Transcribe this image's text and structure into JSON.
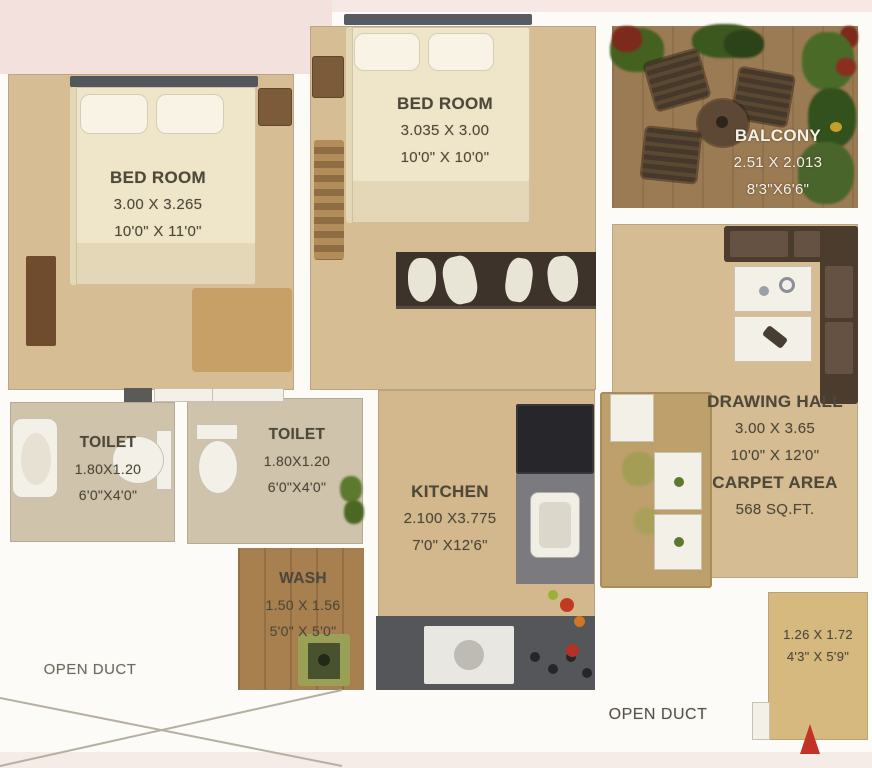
{
  "plan_title": "2 BHK residential floor plan",
  "rooms": {
    "bedroom_left": {
      "name": "BED ROOM",
      "dim_m": "3.00 X 3.265",
      "dim_ft": "10'0\" X 11'0\""
    },
    "bedroom_top": {
      "name": "BED ROOM",
      "dim_m": "3.035 X 3.00",
      "dim_ft": "10'0\" X 10'0\""
    },
    "balcony": {
      "name": "BALCONY",
      "dim_m": "2.51 X 2.013",
      "dim_ft": "8'3\"X6'6\""
    },
    "toilet_left": {
      "name": "TOILET",
      "dim_m": "1.80X1.20",
      "dim_ft": "6'0\"X4'0\""
    },
    "toilet_right": {
      "name": "TOILET",
      "dim_m": "1.80X1.20",
      "dim_ft": "6'0\"X4'0\""
    },
    "kitchen": {
      "name": "KITCHEN",
      "dim_m": "2.100 X3.775",
      "dim_ft": "7'0\" X12'6\""
    },
    "wash": {
      "name": "WASH",
      "dim_m": "1.50 X 1.56",
      "dim_ft": "5'0\" X 5'0\""
    },
    "drawing_hall": {
      "name": "DRAWING HALL",
      "dim_m": "3.00 X 3.65",
      "dim_ft": "10'0\" X 12'0\""
    },
    "entry": {
      "dim_m": "1.26 X 1.72",
      "dim_ft": "4'3\" X 5'9\""
    }
  },
  "carpet_area": {
    "label": "CARPET AREA",
    "value": "568 SQ.FT."
  },
  "ducts": {
    "left": "OPEN DUCT",
    "right": "OPEN DUCT"
  },
  "colors": {
    "floor_tan": "#d7bd93",
    "balcony_wood": "#9b7b53",
    "wash_wood": "#a8804f",
    "toilet_floor": "#cfc3ab",
    "wall_white": "#fcfbf8",
    "outside_pink": "#f3e1dd",
    "label_text": "#4d4839",
    "balcony_text": "#f4f1e8",
    "entry_arrow_red": "#c23227",
    "sofa_brown": "#4c3c2e",
    "counter_dark": "#54565a",
    "plant_green": "#45611f"
  }
}
